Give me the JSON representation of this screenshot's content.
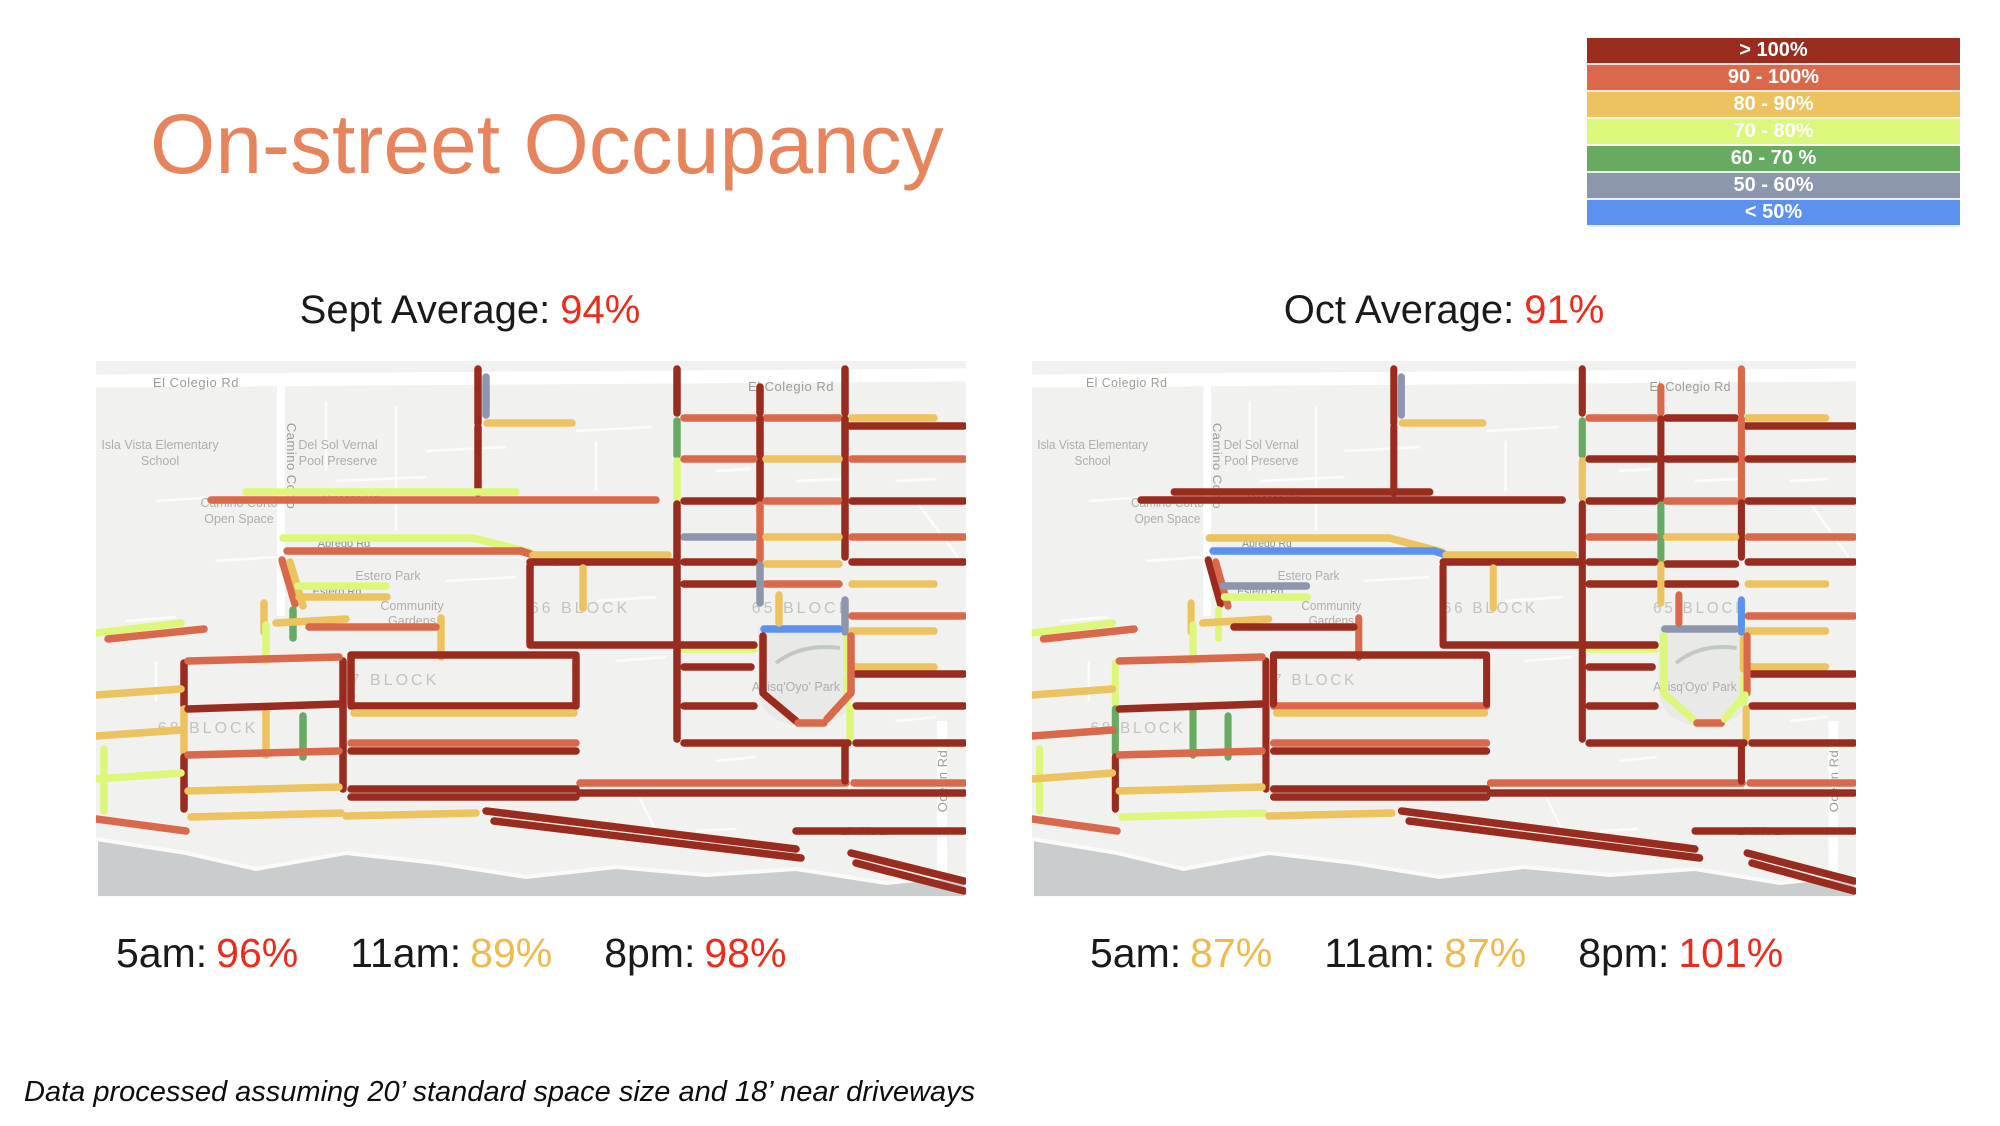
{
  "title": "On-street Occupancy",
  "legend": {
    "items": [
      {
        "label": "> 100%",
        "color": "#9a2b1f"
      },
      {
        "label": "90 - 100%",
        "color": "#d9694a"
      },
      {
        "label": "80 - 90%",
        "color": "#ecc35e"
      },
      {
        "label": "70 - 80%",
        "color": "#dcf87a"
      },
      {
        "label": "60 - 70 %",
        "color": "#66ab61"
      },
      {
        "label": "50 - 60%",
        "color": "#8c96ac"
      },
      {
        "label": "< 50%",
        "color": "#5b92f0"
      }
    ]
  },
  "stat_colors": {
    "red": "#ee2a1b",
    "yellow": "#f0b94e"
  },
  "panels": [
    {
      "id": "sept",
      "subtitle_label": "Sept Average:",
      "subtitle_value": "94%",
      "value_color": "red",
      "stats": [
        {
          "label": "5am:",
          "value": "96%",
          "color": "red"
        },
        {
          "label": "11am:",
          "value": "89%",
          "color": "yellow"
        },
        {
          "label": "8pm:",
          "value": "98%",
          "color": "red"
        }
      ]
    },
    {
      "id": "oct",
      "subtitle_label": "Oct Average:",
      "subtitle_value": "91%",
      "value_color": "red",
      "stats": [
        {
          "label": "5am:",
          "value": "87%",
          "color": "yellow"
        },
        {
          "label": "11am:",
          "value": "87%",
          "color": "yellow"
        },
        {
          "label": "8pm:",
          "value": "101%",
          "color": "red"
        }
      ]
    }
  ],
  "footnote": "Data processed assuming 20’ standard space size and 18’ near driveways",
  "map": {
    "colors": {
      "land": "#f1f1ef",
      "ocean": "#c9cdcd",
      "park": "#e9e9e7",
      "road": "#ffffff",
      "creek": "#c2c8c6",
      "beach": "#fafaf8"
    },
    "category_colors": {
      "dr": "#9a2b1f",
      "or": "#d9694a",
      "yl": "#ecc35e",
      "yg": "#dcf87a",
      "gn": "#66ab61",
      "gy": "#8c96ac",
      "bl": "#5b92f0"
    },
    "labels": [
      {
        "t": "El Colegio Rd",
        "x": 100,
        "y": 26,
        "cls": "street-lg"
      },
      {
        "t": "El Colegio Rd",
        "x": 695,
        "y": 30,
        "cls": "street-lg"
      },
      {
        "t": "Camino Corto",
        "x": 191,
        "y": 105,
        "cls": "street-lg",
        "rot": 90
      },
      {
        "t": "Isla Vista Elementary",
        "x": 64,
        "y": 88,
        "cls": "area"
      },
      {
        "t": "School",
        "x": 64,
        "y": 104,
        "cls": "area"
      },
      {
        "t": "Del Sol Vernal",
        "x": 242,
        "y": 88,
        "cls": "area"
      },
      {
        "t": "Pool Preserve",
        "x": 242,
        "y": 104,
        "cls": "area"
      },
      {
        "t": "Camino Corto",
        "x": 143,
        "y": 146,
        "cls": "area"
      },
      {
        "t": "Open Space",
        "x": 143,
        "y": 162,
        "cls": "area"
      },
      {
        "t": "Picasso Rd",
        "x": 255,
        "y": 141,
        "cls": "street"
      },
      {
        "t": "Abrego Rd",
        "x": 248,
        "y": 186,
        "cls": "street"
      },
      {
        "t": "Abrego Rd",
        "x": 523,
        "y": 199,
        "cls": "street"
      },
      {
        "t": "Estero Park",
        "x": 292,
        "y": 219,
        "cls": "area"
      },
      {
        "t": "Estero Rd",
        "x": 241,
        "y": 234,
        "cls": "street"
      },
      {
        "t": "Community",
        "x": 316,
        "y": 249,
        "cls": "area"
      },
      {
        "t": "Gardens",
        "x": 316,
        "y": 264,
        "cls": "area"
      },
      {
        "t": "66 BLOCK",
        "x": 484,
        "y": 252,
        "cls": "block"
      },
      {
        "t": "65 BLOCK",
        "x": 706,
        "y": 252,
        "cls": "block"
      },
      {
        "t": "67 BLOCK",
        "x": 293,
        "y": 324,
        "cls": "block"
      },
      {
        "t": "68 BLOCK",
        "x": 112,
        "y": 372,
        "cls": "block"
      },
      {
        "t": "Anisq'Oyo' Park",
        "x": 700,
        "y": 330,
        "cls": "area"
      },
      {
        "t": "Ocean Rd",
        "x": 851,
        "y": 420,
        "cls": "street-lg",
        "rot": -90
      },
      {
        "t": "El Nido Ln",
        "x": 770,
        "y": 474,
        "cls": "street"
      }
    ],
    "segments": [
      [
        382,
        8,
        382,
        62,
        "dr",
        "dr"
      ],
      [
        390,
        16,
        390,
        54,
        "gy",
        "gy"
      ],
      [
        382,
        66,
        382,
        132,
        "dr",
        "dr"
      ],
      [
        581,
        8,
        581,
        52,
        "dr",
        "dr"
      ],
      [
        664,
        26,
        664,
        52,
        "dr",
        "or"
      ],
      [
        749,
        8,
        749,
        52,
        "dr",
        "or"
      ],
      [
        391,
        62,
        476,
        62,
        "yl",
        "yl"
      ],
      [
        588,
        57,
        658,
        57,
        "or",
        "or"
      ],
      [
        670,
        57,
        743,
        57,
        "or",
        "dr"
      ],
      [
        756,
        57,
        838,
        57,
        "yl",
        "yl"
      ],
      [
        754,
        65,
        868,
        65,
        "dr",
        "dr"
      ],
      [
        581,
        60,
        581,
        94,
        "gn",
        "gn"
      ],
      [
        581,
        100,
        581,
        137,
        "yg",
        "yl"
      ],
      [
        664,
        58,
        664,
        138,
        "dr",
        "dr"
      ],
      [
        749,
        58,
        749,
        138,
        "dr",
        "or"
      ],
      [
        588,
        98,
        658,
        98,
        "or",
        "dr"
      ],
      [
        670,
        98,
        743,
        98,
        "yl",
        "dr"
      ],
      [
        756,
        98,
        868,
        98,
        "or",
        "dr"
      ],
      [
        588,
        140,
        658,
        140,
        "dr",
        "dr"
      ],
      [
        670,
        140,
        743,
        140,
        "or",
        "or"
      ],
      [
        756,
        140,
        868,
        140,
        "dr",
        "dr"
      ],
      [
        664,
        144,
        664,
        198,
        "or",
        "gn"
      ],
      [
        749,
        142,
        749,
        196,
        "dr",
        "dr"
      ],
      [
        588,
        176,
        658,
        176,
        "gy",
        "or"
      ],
      [
        670,
        176,
        743,
        176,
        "yl",
        "yl"
      ],
      [
        756,
        176,
        868,
        176,
        "or",
        "or"
      ],
      [
        588,
        201,
        658,
        201,
        "dr",
        "dr"
      ],
      [
        670,
        203,
        743,
        203,
        "yl",
        "dr"
      ],
      [
        756,
        201,
        868,
        201,
        "dr",
        "dr"
      ],
      [
        588,
        223,
        658,
        223,
        "dr",
        "dr"
      ],
      [
        670,
        223,
        743,
        223,
        "or",
        "dr"
      ],
      [
        756,
        223,
        838,
        223,
        "yl",
        "yl"
      ],
      [
        581,
        143,
        581,
        282,
        "dr",
        "dr"
      ],
      [
        664,
        204,
        664,
        242,
        "gy",
        "yl"
      ],
      [
        749,
        239,
        749,
        271,
        "gy",
        "bl"
      ],
      [
        668,
        268,
        743,
        268,
        "bl",
        "gy"
      ],
      [
        588,
        288,
        658,
        288,
        "yg",
        "yg"
      ],
      [
        756,
        255,
        868,
        255,
        "or",
        "or"
      ],
      [
        756,
        270,
        838,
        270,
        "yl",
        "yl"
      ],
      [
        751,
        278,
        751,
        308,
        "yg",
        "yl"
      ],
      [
        756,
        306,
        838,
        306,
        "yl",
        "yl"
      ],
      [
        760,
        313,
        868,
        313,
        "dr",
        "dr"
      ],
      [
        751,
        316,
        751,
        342,
        "yg",
        "yg"
      ],
      [
        683,
        234,
        683,
        262,
        "yl",
        "or"
      ],
      [
        150,
        131,
        420,
        131,
        "yg",
        "dr"
      ],
      [
        115,
        139,
        560,
        139,
        "or",
        "dr"
      ],
      [
        434,
        205,
        434,
        282,
        "dr",
        "dr"
      ],
      [
        187,
        177,
        377,
        177,
        "yg",
        "yl"
      ],
      [
        377,
        177,
        433,
        191,
        "yg",
        "yl"
      ],
      [
        191,
        190,
        425,
        190,
        "or",
        "bl"
      ],
      [
        425,
        190,
        459,
        201,
        "or",
        "bl"
      ],
      [
        186,
        199,
        199,
        243,
        "or",
        "dr"
      ],
      [
        194,
        201,
        207,
        245,
        "yl",
        "or"
      ],
      [
        202,
        225,
        290,
        225,
        "yg",
        "gy"
      ],
      [
        203,
        236,
        291,
        236,
        "yl",
        "yg"
      ],
      [
        168,
        242,
        168,
        271,
        "yl",
        "yl"
      ],
      [
        197,
        249,
        197,
        277,
        "gn",
        "yg"
      ],
      [
        437,
        194,
        572,
        194,
        "yl",
        "yl"
      ],
      [
        434,
        201,
        577,
        201,
        "dr",
        "dr"
      ],
      [
        487,
        207,
        487,
        247,
        "yl",
        "yl"
      ],
      [
        434,
        284,
        658,
        284,
        "dr",
        "dr"
      ],
      [
        667,
        275,
        667,
        332,
        "dr",
        "yg"
      ],
      [
        669,
        334,
        700,
        360,
        "dr",
        "yg"
      ],
      [
        702,
        362,
        728,
        362,
        "or",
        "or"
      ],
      [
        755,
        275,
        755,
        332,
        "or",
        "or"
      ],
      [
        753,
        334,
        731,
        358,
        "or",
        "yg"
      ],
      [
        588,
        306,
        655,
        306,
        "dr",
        "dr"
      ],
      [
        581,
        288,
        581,
        378,
        "dr",
        "dr"
      ],
      [
        588,
        345,
        658,
        345,
        "dr",
        "dr"
      ],
      [
        760,
        345,
        868,
        345,
        "dr",
        "dr"
      ],
      [
        754,
        348,
        754,
        378,
        "yg",
        "yl"
      ],
      [
        588,
        382,
        752,
        382,
        "dr",
        "dr"
      ],
      [
        760,
        382,
        868,
        382,
        "dr",
        "dr"
      ],
      [
        484,
        422,
        750,
        422,
        "or",
        "or"
      ],
      [
        758,
        422,
        868,
        422,
        "or",
        "or"
      ],
      [
        484,
        432,
        868,
        432,
        "dr",
        "dr"
      ],
      [
        749,
        385,
        749,
        420,
        "dr",
        "dr"
      ],
      [
        390,
        450,
        700,
        488,
        "dr",
        "dr"
      ],
      [
        398,
        460,
        705,
        497,
        "dr",
        "dr"
      ],
      [
        755,
        492,
        868,
        520,
        "dr",
        "dr"
      ],
      [
        760,
        502,
        868,
        530,
        "dr",
        "dr"
      ],
      [
        700,
        470,
        868,
        470,
        "dr",
        "dr"
      ],
      [
        345,
        257,
        345,
        296,
        "yl",
        "or"
      ],
      [
        247,
        300,
        247,
        428,
        "dr",
        "dr"
      ],
      [
        88,
        302,
        88,
        344,
        "dr",
        "yg"
      ],
      [
        88,
        348,
        88,
        392,
        "yl",
        "gn"
      ],
      [
        88,
        396,
        88,
        448,
        "dr",
        "dr"
      ],
      [
        8,
        388,
        8,
        450,
        "yg",
        "yg"
      ],
      [
        170,
        264,
        170,
        300,
        "yg",
        "yg"
      ],
      [
        207,
        355,
        207,
        396,
        "gn",
        "gn"
      ],
      [
        170,
        350,
        170,
        394,
        "yl",
        "gn"
      ],
      [
        0,
        272,
        85,
        262,
        "yg",
        "yg"
      ],
      [
        12,
        278,
        108,
        268,
        "or",
        "or"
      ],
      [
        180,
        262,
        250,
        258,
        "yl",
        "yl"
      ],
      [
        213,
        266,
        340,
        266,
        "or",
        "dr"
      ],
      [
        92,
        300,
        243,
        296,
        "or",
        "or"
      ],
      [
        0,
        334,
        85,
        328,
        "yl",
        "yl"
      ],
      [
        92,
        348,
        243,
        343,
        "dr",
        "dr"
      ],
      [
        0,
        375,
        85,
        369,
        "yl",
        "or"
      ],
      [
        92,
        394,
        243,
        390,
        "or",
        "or"
      ],
      [
        0,
        418,
        85,
        412,
        "yg",
        "yl"
      ],
      [
        92,
        430,
        243,
        426,
        "yl",
        "yl"
      ],
      [
        95,
        456,
        245,
        452,
        "yl",
        "yg"
      ],
      [
        250,
        455,
        380,
        452,
        "yl",
        "yl"
      ],
      [
        0,
        458,
        90,
        470,
        "or",
        "or"
      ],
      [
        255,
        294,
        480,
        294,
        "dr",
        "dr"
      ],
      [
        255,
        345,
        480,
        345,
        "dr",
        "or"
      ],
      [
        258,
        352,
        478,
        352,
        "yl",
        "yl"
      ],
      [
        255,
        382,
        480,
        382,
        "or",
        "or"
      ],
      [
        255,
        390,
        480,
        390,
        "dr",
        "dr"
      ],
      [
        255,
        428,
        480,
        428,
        "dr",
        "dr"
      ],
      [
        255,
        436,
        480,
        436,
        "dr",
        "dr"
      ],
      [
        255,
        296,
        255,
        343,
        "dr",
        "dr"
      ],
      [
        480,
        296,
        480,
        343,
        "dr",
        "dr"
      ]
    ]
  }
}
